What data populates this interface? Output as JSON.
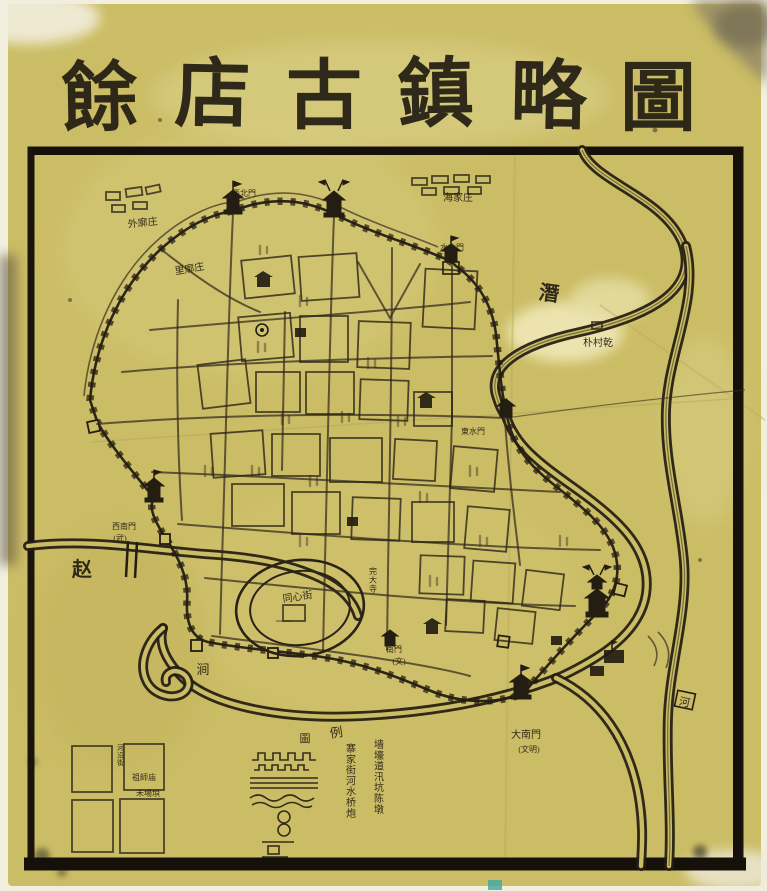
{
  "title": {
    "text": "餘店古鎮略圖",
    "chars": [
      "餘",
      "店",
      "古",
      "鎮",
      "略",
      "圖"
    ]
  },
  "labels": {
    "villages": {
      "nw": "外廓庄",
      "n": "海家庄",
      "inner": "里廓庄",
      "e": "朴村乾"
    },
    "gates": {
      "nw": "西北門",
      "n_water": "水北門",
      "e_water": "東水門",
      "sw": "西南門",
      "sw_sub": "(武)",
      "s": "南門",
      "s_sub": "(文)",
      "s_main": "大南門",
      "s_main_sub": "(文明)"
    },
    "rivers": {
      "qian": "潛",
      "zhao": "赵",
      "he": "河",
      "stream": "涧"
    },
    "streets": {
      "oval": "同心街",
      "riverside": "河沿街"
    },
    "sites": {
      "temple_se": "完大寺",
      "temple_zushi": "祖師庙",
      "field": "禾場垻"
    },
    "legend": {
      "tu": "圖",
      "li": "例",
      "col_right": "墙壕道汛坑陈墩",
      "col_left": "寨家街河水桥炮"
    }
  },
  "colors": {
    "paper": "#cbbd65",
    "paper_light": "#ddd28b",
    "ink": "#2a2217",
    "frame": "#1a140c",
    "river": "#241d12",
    "stain_light": "#ece3ab",
    "stain_dark": "#8f8566",
    "photo_margin": "#f3efdf"
  }
}
